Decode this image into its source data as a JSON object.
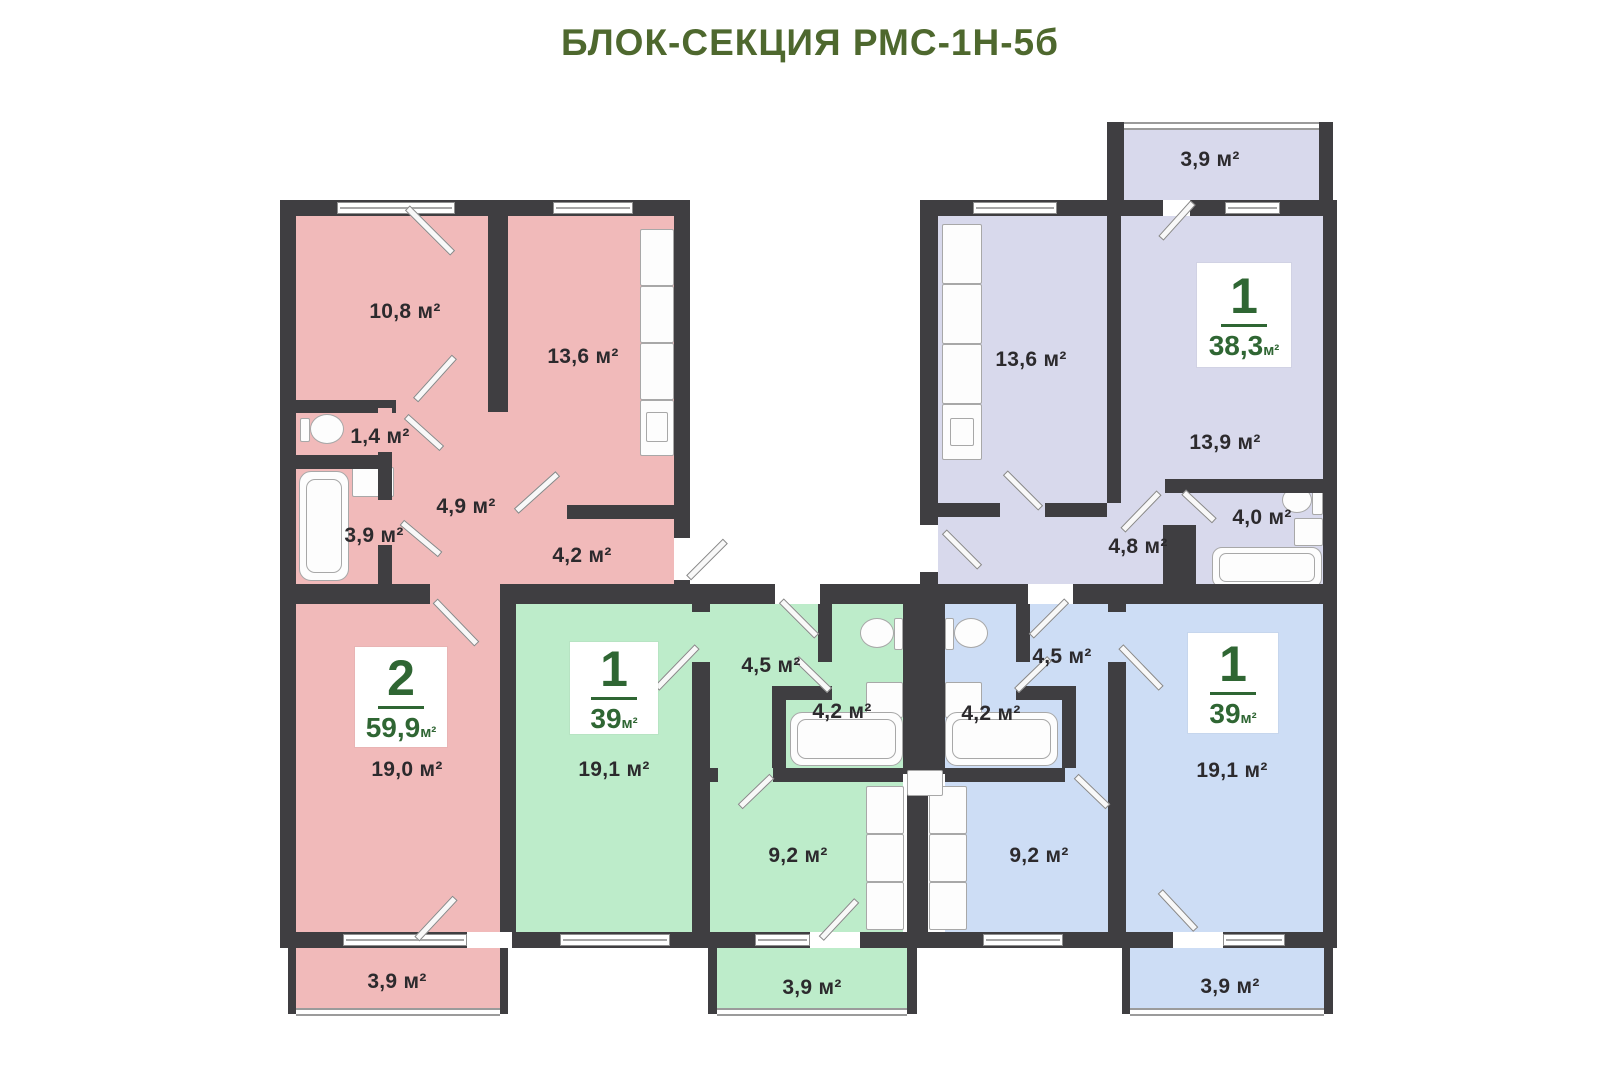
{
  "title": "БЛОК-СЕКЦИЯ РМС-1Н-5б",
  "colors": {
    "walls": "#3f3e41",
    "apartment_pink": "#f1baba",
    "apartment_green": "#bdecca",
    "apartment_blue": "#cdddf5",
    "apartment_lavender": "#d8d9ec",
    "badge_accent_green": "#2f6633",
    "title_green": "#4e682e"
  },
  "apartments": [
    {
      "id": "pink-2-room",
      "badge": {
        "rooms": "2",
        "area": "59,9",
        "unit": "м²"
      },
      "rooms": [
        {
          "name": "bedroom",
          "area": "10,8 м²"
        },
        {
          "name": "kitchen-room",
          "area": "13,6 м²"
        },
        {
          "name": "wc",
          "area": "1,4 м²"
        },
        {
          "name": "bathroom",
          "area": "3,9 м²"
        },
        {
          "name": "hallway",
          "area": "4,9 м²"
        },
        {
          "name": "corridor",
          "area": "4,2 м²"
        },
        {
          "name": "living-room",
          "area": "19,0 м²"
        },
        {
          "name": "balcony",
          "area": "3,9 м²"
        }
      ]
    },
    {
      "id": "green-1-room",
      "badge": {
        "rooms": "1",
        "area": "39",
        "unit": "м²"
      },
      "rooms": [
        {
          "name": "living-room",
          "area": "19,1 м²"
        },
        {
          "name": "hallway",
          "area": "4,5 м²"
        },
        {
          "name": "bathroom",
          "area": "4,2 м²"
        },
        {
          "name": "kitchen",
          "area": "9,2 м²"
        },
        {
          "name": "balcony",
          "area": "3,9 м²"
        }
      ]
    },
    {
      "id": "blue-1-room",
      "badge": {
        "rooms": "1",
        "area": "39",
        "unit": "м²"
      },
      "rooms": [
        {
          "name": "hallway",
          "area": "4,5 м²"
        },
        {
          "name": "bathroom",
          "area": "4,2 м²"
        },
        {
          "name": "kitchen",
          "area": "9,2 м²"
        },
        {
          "name": "living-room",
          "area": "19,1 м²"
        },
        {
          "name": "balcony",
          "area": "3,9 м²"
        }
      ]
    },
    {
      "id": "lavender-1-room",
      "badge": {
        "rooms": "1",
        "area": "38,3",
        "unit": "м²"
      },
      "rooms": [
        {
          "name": "balcony",
          "area": "3,9 м²"
        },
        {
          "name": "kitchen",
          "area": "13,6 м²"
        },
        {
          "name": "living-room",
          "area": "13,9 м²"
        },
        {
          "name": "hallway",
          "area": "4,8 м²"
        },
        {
          "name": "bathroom",
          "area": "4,0 м²"
        }
      ]
    }
  ]
}
